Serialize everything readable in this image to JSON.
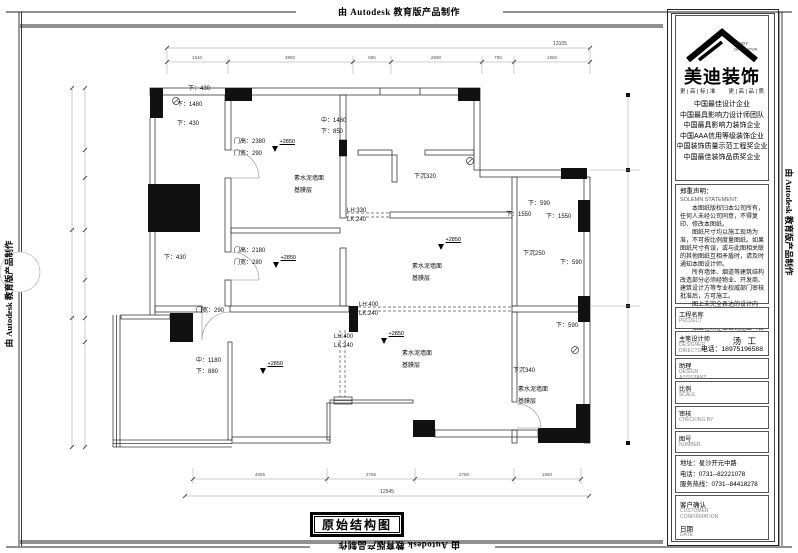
{
  "banner": {
    "text": "由 Autodesk 教育版产品制作"
  },
  "titleblock": {
    "logo": {
      "brand": "美迪装饰",
      "sub_top": "MEIDY",
      "sub_bottom": "DECORATION",
      "slogan_left": "更 | 高 | 标 | 准",
      "slogan_right": "更 | 高 | 品 | 质",
      "accolades": [
        "中国最佳设计企业",
        "中国最具影响力设计师团队",
        "中国最具影响力装饰企业",
        "中国AAA信用等级装饰企业",
        "中国装饰质量示范工程奖企业",
        "中国最佳装饰品质奖企业"
      ]
    },
    "statement": {
      "title_cn": "郑重声明：",
      "title_en": "SOLEMN STATEMENT:",
      "paragraphs": [
        "本图纸版权归本公司所有，任何人未经公司同意，不得复印、修改本图纸。",
        "图纸尺寸均以施工现场为准，不可按比例度量图纸。如果图纸尺寸有误，或与此图相关联的其他图纸互相矛盾时，请及时通知本图设计师。",
        "所有墙体、烟道等建筑结构改造部分必须经物业、开发商、建筑设计方等专业权威部门审核批准后，方可施工。",
        "图上未完全表达的设计内容，施工时应及时参照国家相关规定实施。",
        "如工程未在本公司施工（含未施工项目），以后出现一切责任与本公司无关。"
      ]
    },
    "fields": [
      {
        "cn": "工程名称",
        "en": [
          "PROJECT"
        ],
        "value": "",
        "extra": ""
      },
      {
        "cn": "主笔设计师",
        "en": [
          "DESIGNER",
          "DIRECTOR"
        ],
        "value": "汤 工",
        "extra": "电话：18975196588"
      },
      {
        "cn": "助理",
        "en": [
          "DESIGN",
          "ASSISTANT"
        ],
        "value": "",
        "extra": ""
      },
      {
        "cn": "比例",
        "en": [
          "SCALE"
        ],
        "value": "",
        "extra": ""
      },
      {
        "cn": "审核",
        "en": [
          "CHECKING BY"
        ],
        "value": "",
        "extra": ""
      },
      {
        "cn": "图号",
        "en": [
          "NUMBER"
        ],
        "value": "",
        "extra": ""
      }
    ],
    "contact": {
      "address": "地址：星沙开元中路",
      "phone": "电话：0731--82221078",
      "hotline": "服务热线：0731--84418278"
    },
    "confirm": {
      "cn": "客户确认",
      "en": [
        "CUSTOMER",
        "CONFIRMATION"
      ],
      "date_cn": "日期",
      "date_en": "DATE"
    }
  },
  "plan": {
    "title": "原始结构图",
    "annotations": [
      {
        "t": "下：430",
        "x": 188,
        "y": 90
      },
      {
        "t": "下：1480",
        "x": 177,
        "y": 106
      },
      {
        "t": "下：430",
        "x": 177,
        "y": 125
      },
      {
        "t": "门高：2380",
        "x": 234,
        "y": 143
      },
      {
        "t": "门宽：290",
        "x": 234,
        "y": 155
      },
      {
        "t": "中：1480",
        "x": 321,
        "y": 122
      },
      {
        "t": "下：850",
        "x": 321,
        "y": 133
      },
      {
        "t": "下沉320",
        "x": 414,
        "y": 178
      },
      {
        "t": "下：590",
        "x": 528,
        "y": 205
      },
      {
        "t": "下：1550",
        "x": 506,
        "y": 216
      },
      {
        "t": "下：1550",
        "x": 546,
        "y": 218
      },
      {
        "t": "LH:330",
        "x": 347,
        "y": 212
      },
      {
        "t": "LK:240",
        "x": 347,
        "y": 221
      },
      {
        "t": "门高：2180",
        "x": 234,
        "y": 252
      },
      {
        "t": "门宽：280",
        "x": 234,
        "y": 264
      },
      {
        "t": "下：430",
        "x": 164,
        "y": 259
      },
      {
        "t": "下沉250",
        "x": 523,
        "y": 255
      },
      {
        "t": "下：590",
        "x": 560,
        "y": 264
      },
      {
        "t": "素水泥墙面",
        "x": 294,
        "y": 180
      },
      {
        "t": "基膜层",
        "x": 294,
        "y": 192
      },
      {
        "t": "素水泥墙面",
        "x": 412,
        "y": 268
      },
      {
        "t": "基膜层",
        "x": 412,
        "y": 280
      },
      {
        "t": "LH:400",
        "x": 359,
        "y": 306
      },
      {
        "t": "LK:240",
        "x": 359,
        "y": 315
      },
      {
        "t": "门宽：290",
        "x": 196,
        "y": 312
      },
      {
        "t": "LH:400",
        "x": 334,
        "y": 338
      },
      {
        "t": "LK:240",
        "x": 334,
        "y": 347
      },
      {
        "t": "下：590",
        "x": 556,
        "y": 327
      },
      {
        "t": "中：1180",
        "x": 196,
        "y": 362
      },
      {
        "t": "下：880",
        "x": 196,
        "y": 373
      },
      {
        "t": "素水泥墙面",
        "x": 402,
        "y": 355
      },
      {
        "t": "基膜层",
        "x": 402,
        "y": 367
      },
      {
        "t": "下沉340",
        "x": 513,
        "y": 372
      },
      {
        "t": "素水泥墙面",
        "x": 518,
        "y": 391
      },
      {
        "t": "基膜层",
        "x": 518,
        "y": 403
      }
    ],
    "elevations": {
      "label": "+2850",
      "points": [
        {
          "x": 275,
          "y": 152
        },
        {
          "x": 276,
          "y": 268
        },
        {
          "x": 441,
          "y": 250
        },
        {
          "x": 384,
          "y": 344
        },
        {
          "x": 263,
          "y": 374
        }
      ]
    },
    "dims": {
      "top_total": "13105",
      "top_segments": [
        "1540",
        "3850",
        "985",
        "2590",
        "780",
        "1950"
      ],
      "bottom_segments": [
        "4055",
        "2755",
        "2780",
        "1960"
      ],
      "bottom_total": "12545"
    }
  }
}
